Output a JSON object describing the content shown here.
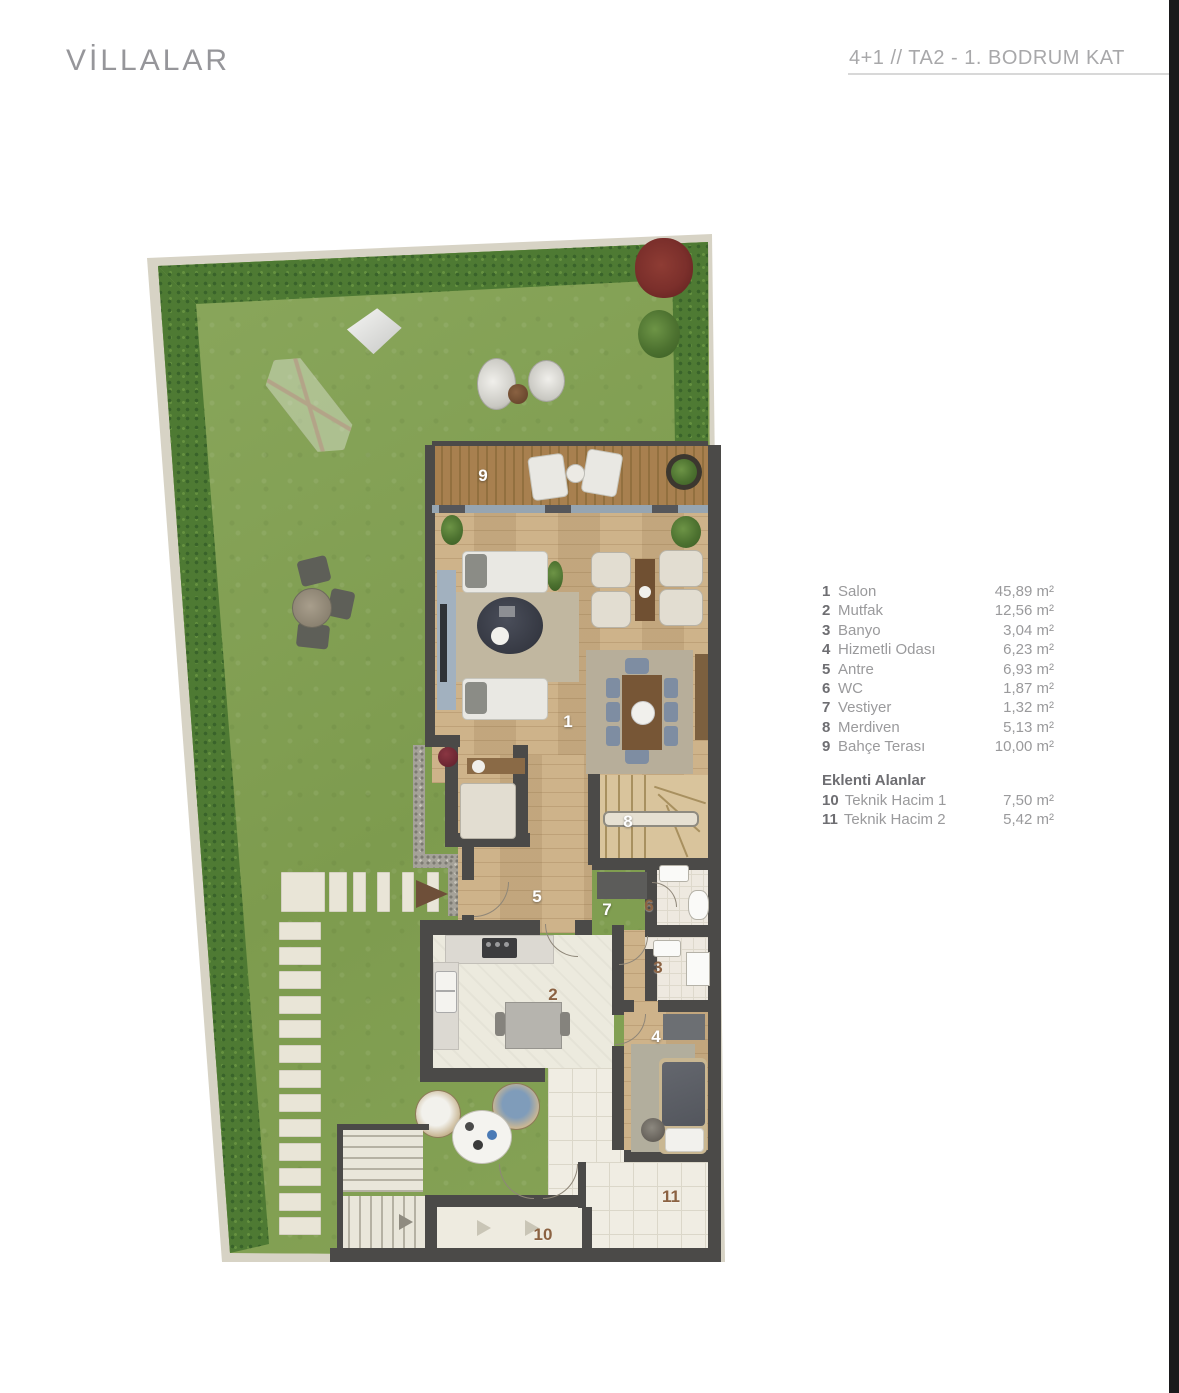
{
  "page": {
    "title": "VİLLALAR",
    "floor_header": "4+1 // TA2 - 1. BODRUM KAT"
  },
  "legend": {
    "items": [
      {
        "num": "1",
        "name": "Salon",
        "area": "45,89 m²"
      },
      {
        "num": "2",
        "name": "Mutfak",
        "area": "12,56 m²"
      },
      {
        "num": "3",
        "name": "Banyo",
        "area": "3,04 m²"
      },
      {
        "num": "4",
        "name": "Hizmetli Odası",
        "area": "6,23 m²"
      },
      {
        "num": "5",
        "name": "Antre",
        "area": "6,93 m²"
      },
      {
        "num": "6",
        "name": "WC",
        "area": "1,87 m²"
      },
      {
        "num": "7",
        "name": "Vestiyer",
        "area": "1,32 m²"
      },
      {
        "num": "8",
        "name": "Merdiven",
        "area": "5,13 m²"
      },
      {
        "num": "9",
        "name": "Bahçe Terası",
        "area": "10,00 m²"
      }
    ],
    "annex_title": "Eklenti Alanlar",
    "annex_items": [
      {
        "num": "10",
        "name": "Teknik Hacim 1",
        "area": "7,50 m²"
      },
      {
        "num": "11",
        "name": "Teknik Hacim 2",
        "area": "5,42 m²"
      }
    ]
  },
  "plan": {
    "labels": [
      {
        "num": "1"
      },
      {
        "num": "2"
      },
      {
        "num": "3"
      },
      {
        "num": "4"
      },
      {
        "num": "5"
      },
      {
        "num": "6"
      },
      {
        "num": "7"
      },
      {
        "num": "8"
      },
      {
        "num": "9"
      },
      {
        "num": "10"
      },
      {
        "num": "11"
      }
    ]
  },
  "colors": {
    "wall": "#4b4a48",
    "grass": "#84a155",
    "hedge": "#4e7a33",
    "label_white": "#ffffff",
    "label_brown": "#8b6242",
    "right_bar": "#1a1a1c"
  }
}
